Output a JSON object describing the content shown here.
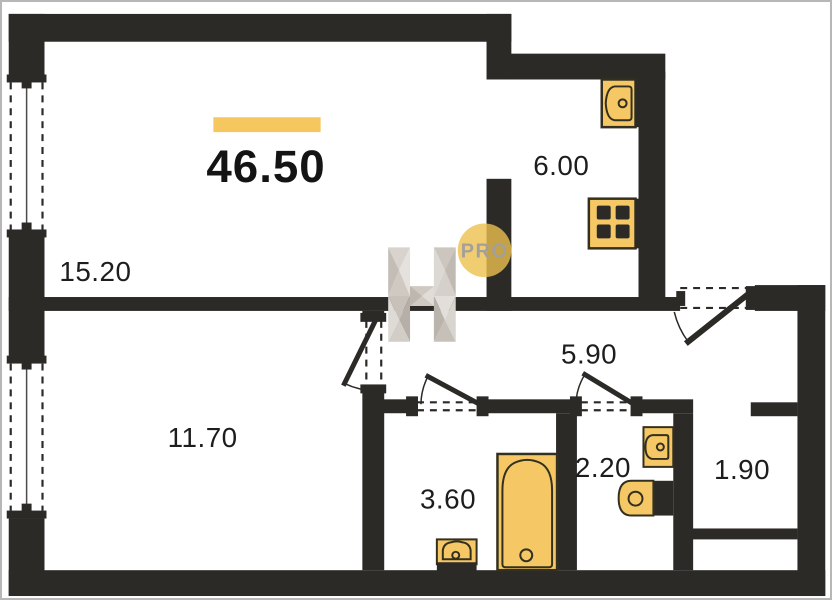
{
  "plan": {
    "total_area_label": "46.50",
    "rooms": [
      {
        "name": "living-room",
        "area_label": "15.20"
      },
      {
        "name": "bedroom",
        "area_label": "11.70"
      },
      {
        "name": "kitchen",
        "area_label": "6.00"
      },
      {
        "name": "hallway",
        "area_label": "5.90"
      },
      {
        "name": "bathroom",
        "area_label": "3.60"
      },
      {
        "name": "wc",
        "area_label": "2.20"
      },
      {
        "name": "closet",
        "area_label": "1.90"
      }
    ],
    "watermark": {
      "badge_text": "PRO",
      "letter_shape": "H"
    },
    "fixtures": [
      {
        "icon": "kitchen-sink-icon",
        "room": "kitchen"
      },
      {
        "icon": "stove-icon",
        "room": "kitchen"
      },
      {
        "icon": "bathtub-icon",
        "room": "bathroom"
      },
      {
        "icon": "washbasin-icon",
        "room": "bathroom"
      },
      {
        "icon": "washbasin-icon",
        "room": "wc"
      },
      {
        "icon": "toilet-icon",
        "room": "wc"
      }
    ],
    "openings": {
      "windows": [
        "left-upper-window",
        "left-lower-window"
      ],
      "doors": [
        "entrance-door",
        "bedroom-door",
        "bathroom-door",
        "wc-door"
      ]
    },
    "colors": {
      "wall": "#2b2a27",
      "fixture": "#f5c765",
      "fixture_stroke": "#33301f",
      "accent_bar": "#f6c75f",
      "label_text": "#1d1d1d",
      "badge_fill": "#eec14f",
      "badge_text": "#a3a09a",
      "frame_border": "#b7b7b7",
      "window_line": "#4a4a48"
    }
  }
}
